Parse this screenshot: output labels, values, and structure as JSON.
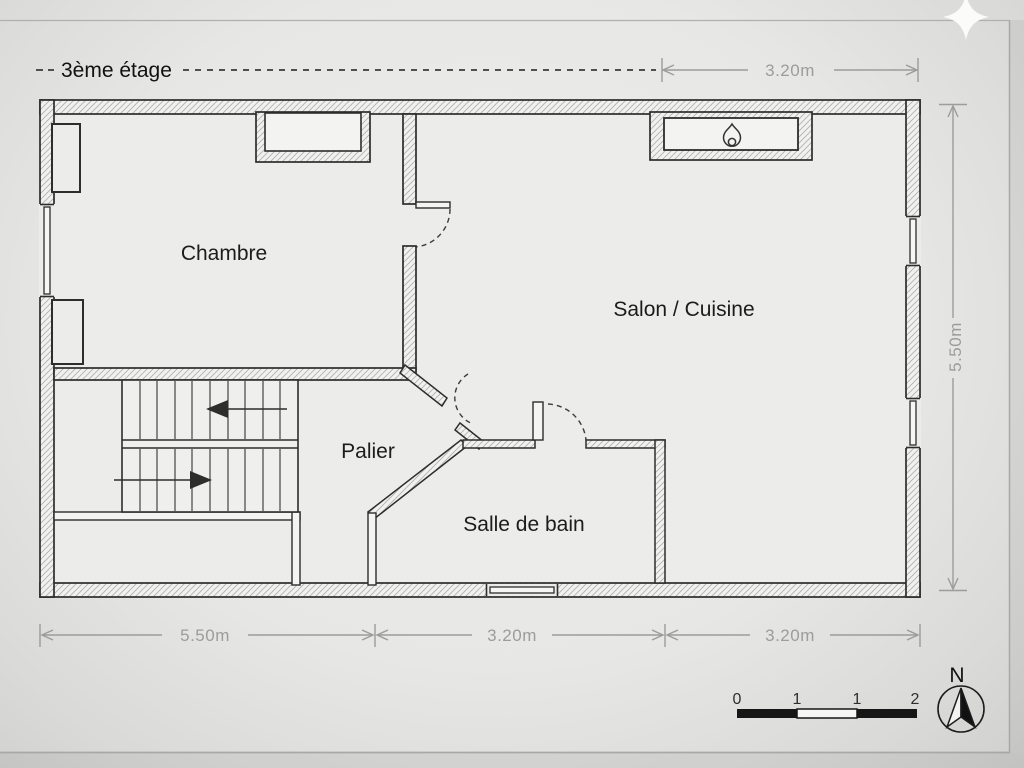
{
  "title": {
    "label": "3ème étage"
  },
  "rooms": {
    "chambre": "Chambre",
    "salon_cuisine": "Salon / Cuisine",
    "palier": "Palier",
    "salle_de_bain": "Salle de bain"
  },
  "dimensions": {
    "top_width": "3.20m",
    "right_height": "5.50m",
    "bottom_left": "5.50m",
    "bottom_middle": "3.20m",
    "bottom_right": "3.20m"
  },
  "scale_bar": {
    "tick_0": "0",
    "tick_1_left": "1",
    "tick_1_right": "1",
    "tick_2": "2"
  },
  "compass": {
    "north_label": "N"
  },
  "icons": {
    "fireplace": "flame-icon",
    "compass": "north-compass-icon",
    "sparkle": "sparkle-icon"
  },
  "colors": {
    "paper": "#ebebe9",
    "plan_line": "#2d2d2d",
    "dimension_gray": "#9c9c9a",
    "hatch_gray": "#b2b2b0",
    "scale_black": "#161616"
  }
}
